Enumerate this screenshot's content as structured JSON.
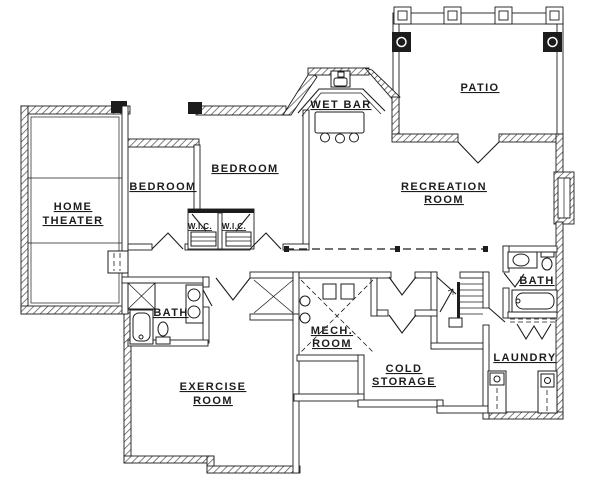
{
  "drawing": {
    "type": "floor-plan",
    "ink_color": "#1c1c1c",
    "paper_color": "#ffffff"
  },
  "rooms": {
    "home_theater": {
      "line1": "HOME",
      "line2": "THEATER"
    },
    "bedroom_left": {
      "line1": "BEDROOM"
    },
    "bedroom_right": {
      "line1": "BEDROOM"
    },
    "wic_left": {
      "line1": "W.I.C."
    },
    "wic_right": {
      "line1": "W.I.C."
    },
    "wet_bar": {
      "line1": "WET BAR"
    },
    "patio": {
      "line1": "PATIO"
    },
    "recreation": {
      "line1": "RECREATION",
      "line2": "ROOM"
    },
    "bath_left": {
      "line1": "BATH"
    },
    "bath_right": {
      "line1": "BATH"
    },
    "exercise": {
      "line1": "EXERCISE",
      "line2": "ROOM"
    },
    "mech": {
      "line1": "MECH.",
      "line2": "ROOM"
    },
    "cold_storage": {
      "line1": "COLD",
      "line2": "STORAGE"
    },
    "laundry": {
      "line1": "LAUNDRY"
    }
  }
}
